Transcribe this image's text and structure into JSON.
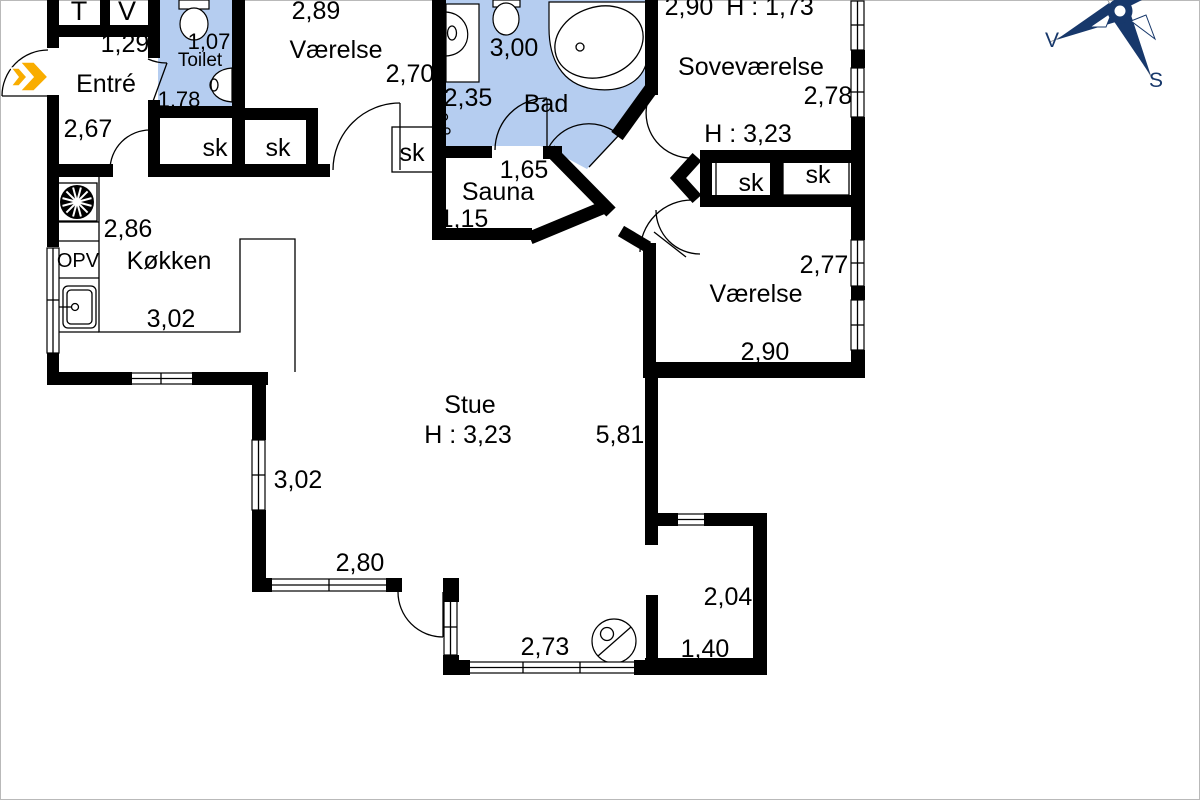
{
  "colors": {
    "wall": "#000000",
    "bath_blue": "#b5cdf0",
    "arrow_yellow": "#f9ad00",
    "compass_navy": "#17386b"
  },
  "compass": {
    "west": "V",
    "south": "S"
  },
  "closet_label": "sk",
  "rooms": {
    "utility": {
      "left": "T",
      "right": "V"
    },
    "entre": {
      "name": "Entré",
      "dim_top": "1,29",
      "dim_left": "2,67"
    },
    "toilet": {
      "name": "Toilet",
      "dim_width": "1,07",
      "dim_depth": "1,78"
    },
    "vaerelse_top": {
      "name": "Værelse",
      "dim_top": "2,89",
      "dim_right": "2,70"
    },
    "bad": {
      "name": "Bad",
      "dim_top": "3,00",
      "dim_left": "2,35"
    },
    "sauna": {
      "name": "Sauna",
      "dim_top": "1,65",
      "dim_left": "1,15"
    },
    "sovevaerelse": {
      "name": "Soveværelse",
      "dim_top": "2,90",
      "ceiling_height": "H : 1,73",
      "dim_right": "2,78"
    },
    "hall": {
      "ceiling_height": "H : 3,23"
    },
    "vaerelse_right": {
      "name": "Værelse",
      "dim_right": "2,77",
      "dim_bottom": "2,90"
    },
    "koekken": {
      "name": "Køkken",
      "dim_top": "2,86",
      "dim_bottom": "3,02",
      "appliance": "OPV"
    },
    "stue": {
      "name": "Stue",
      "ceiling_height": "H : 3,23",
      "dim_right": "5,81",
      "dim_left": "3,02",
      "dim_bottom_left": "2,80",
      "dim_bottom": "2,73"
    },
    "vestibule": {
      "dim_width": "2,04",
      "dim_depth": "1,40"
    }
  }
}
